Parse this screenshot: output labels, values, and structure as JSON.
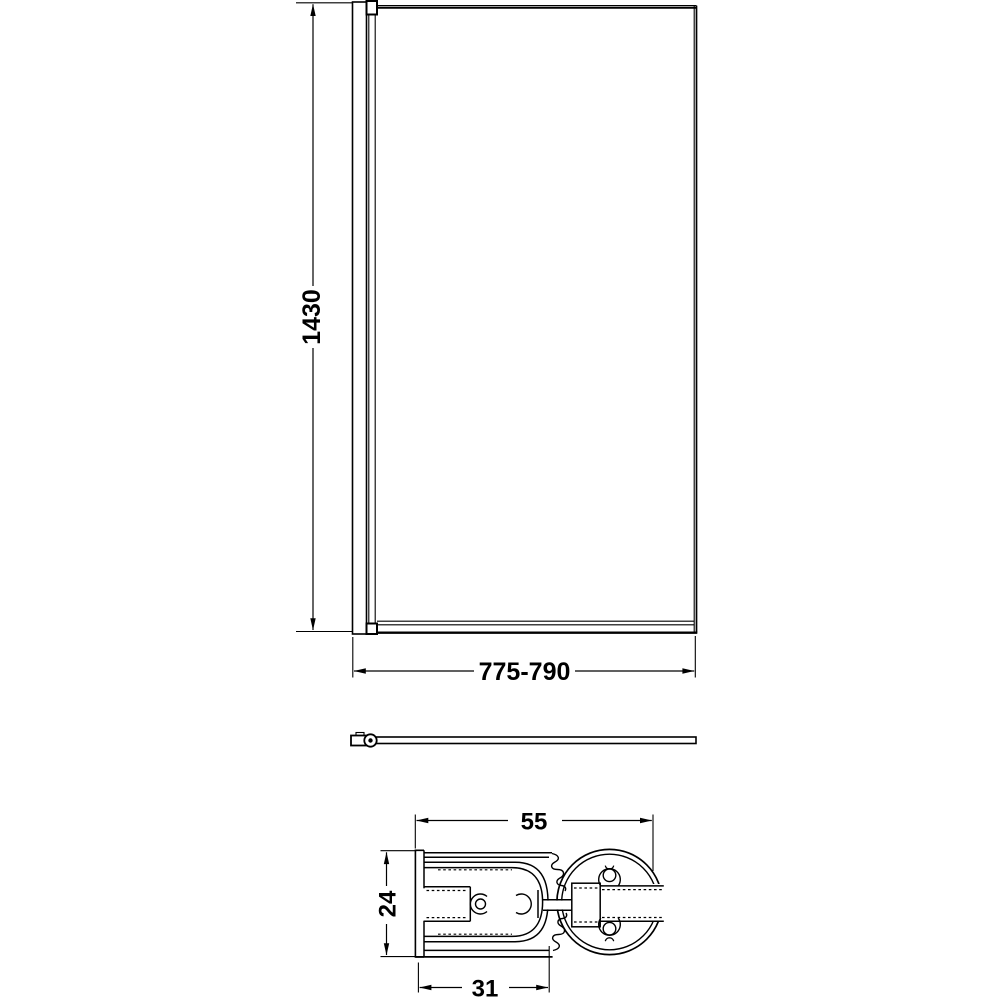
{
  "drawing": {
    "background_color": "#ffffff",
    "line_color": "#000000",
    "dimensions": {
      "height": "1430",
      "width_range": "775-790",
      "section_overall_width": "55",
      "section_depth": "24",
      "section_channel_width": "31"
    }
  }
}
